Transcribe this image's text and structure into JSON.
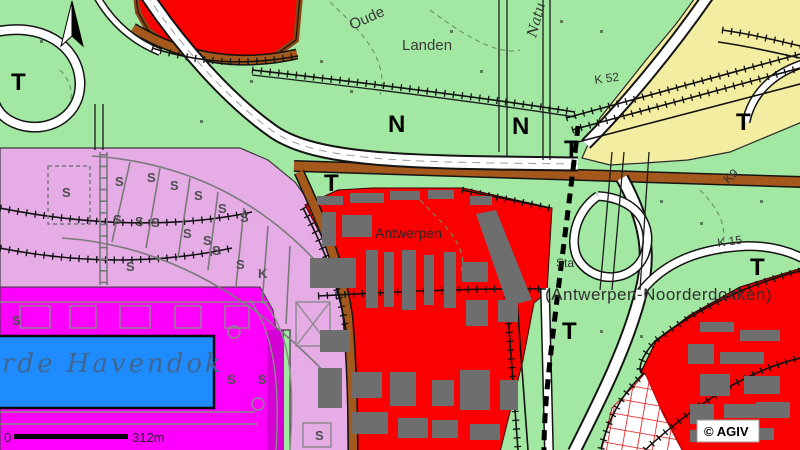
{
  "map": {
    "attribution": "© AGIV",
    "scale_bar": {
      "zero_label": "0",
      "distance_label": "312m"
    },
    "labels": {
      "oude": "Oude",
      "landen": "Landen",
      "natuur_partial": "Natu",
      "k52": "K 52",
      "k9": "K9",
      "k15": "K 15",
      "antwerpen": "Antwerpen",
      "station_partial": "Sta",
      "noorderdokken": "(Antwerpen-Noorderdokken)",
      "havendok_partial": "rde  Havendok"
    },
    "zone_letters": [
      {
        "ch": "T",
        "x": 11,
        "y": 90,
        "cls": "big"
      },
      {
        "ch": "N",
        "x": 388,
        "y": 132,
        "cls": "big"
      },
      {
        "ch": "N",
        "x": 512,
        "y": 134,
        "cls": "big"
      },
      {
        "ch": "T",
        "x": 324,
        "y": 191,
        "cls": "big"
      },
      {
        "ch": "T",
        "x": 564,
        "y": 157,
        "cls": "big"
      },
      {
        "ch": "T",
        "x": 736,
        "y": 130,
        "cls": "big"
      },
      {
        "ch": "T",
        "x": 750,
        "y": 275,
        "cls": "big"
      },
      {
        "ch": "T",
        "x": 562,
        "y": 339,
        "cls": "big"
      },
      {
        "ch": "S",
        "x": 62,
        "y": 197,
        "cls": "small"
      },
      {
        "ch": "S",
        "x": 115,
        "y": 186,
        "cls": "small"
      },
      {
        "ch": "S",
        "x": 147,
        "y": 182,
        "cls": "small"
      },
      {
        "ch": "S",
        "x": 170,
        "y": 190,
        "cls": "small"
      },
      {
        "ch": "S",
        "x": 194,
        "y": 200,
        "cls": "small"
      },
      {
        "ch": "S",
        "x": 218,
        "y": 213,
        "cls": "small"
      },
      {
        "ch": "S",
        "x": 240,
        "y": 222,
        "cls": "small"
      },
      {
        "ch": "S",
        "x": 113,
        "y": 224,
        "cls": "small"
      },
      {
        "ch": "S",
        "x": 135,
        "y": 226,
        "cls": "small"
      },
      {
        "ch": "S",
        "x": 151,
        "y": 227,
        "cls": "small"
      },
      {
        "ch": "S",
        "x": 183,
        "y": 238,
        "cls": "small"
      },
      {
        "ch": "S",
        "x": 203,
        "y": 245,
        "cls": "small"
      },
      {
        "ch": "S",
        "x": 212,
        "y": 255,
        "cls": "small"
      },
      {
        "ch": "S",
        "x": 126,
        "y": 271,
        "cls": "small"
      },
      {
        "ch": "S",
        "x": 236,
        "y": 269,
        "cls": "small"
      },
      {
        "ch": "K",
        "x": 258,
        "y": 278,
        "cls": "small"
      },
      {
        "ch": "S",
        "x": 12,
        "y": 325,
        "cls": "small"
      },
      {
        "ch": "S",
        "x": 227,
        "y": 384,
        "cls": "small"
      },
      {
        "ch": "S",
        "x": 258,
        "y": 384,
        "cls": "small"
      },
      {
        "ch": "S",
        "x": 315,
        "y": 440,
        "cls": "small"
      }
    ],
    "colors": {
      "green": "#A2E8A2",
      "red": "#FA0000",
      "lilac": "#E5ACE5",
      "magenta": "#FF00FF",
      "magenta_dark": "#D400D4",
      "blue": "#1E8CFF",
      "yellow": "#F2EDA0",
      "brown": "#A4581C",
      "white_zone": "#FFFFFF"
    }
  }
}
